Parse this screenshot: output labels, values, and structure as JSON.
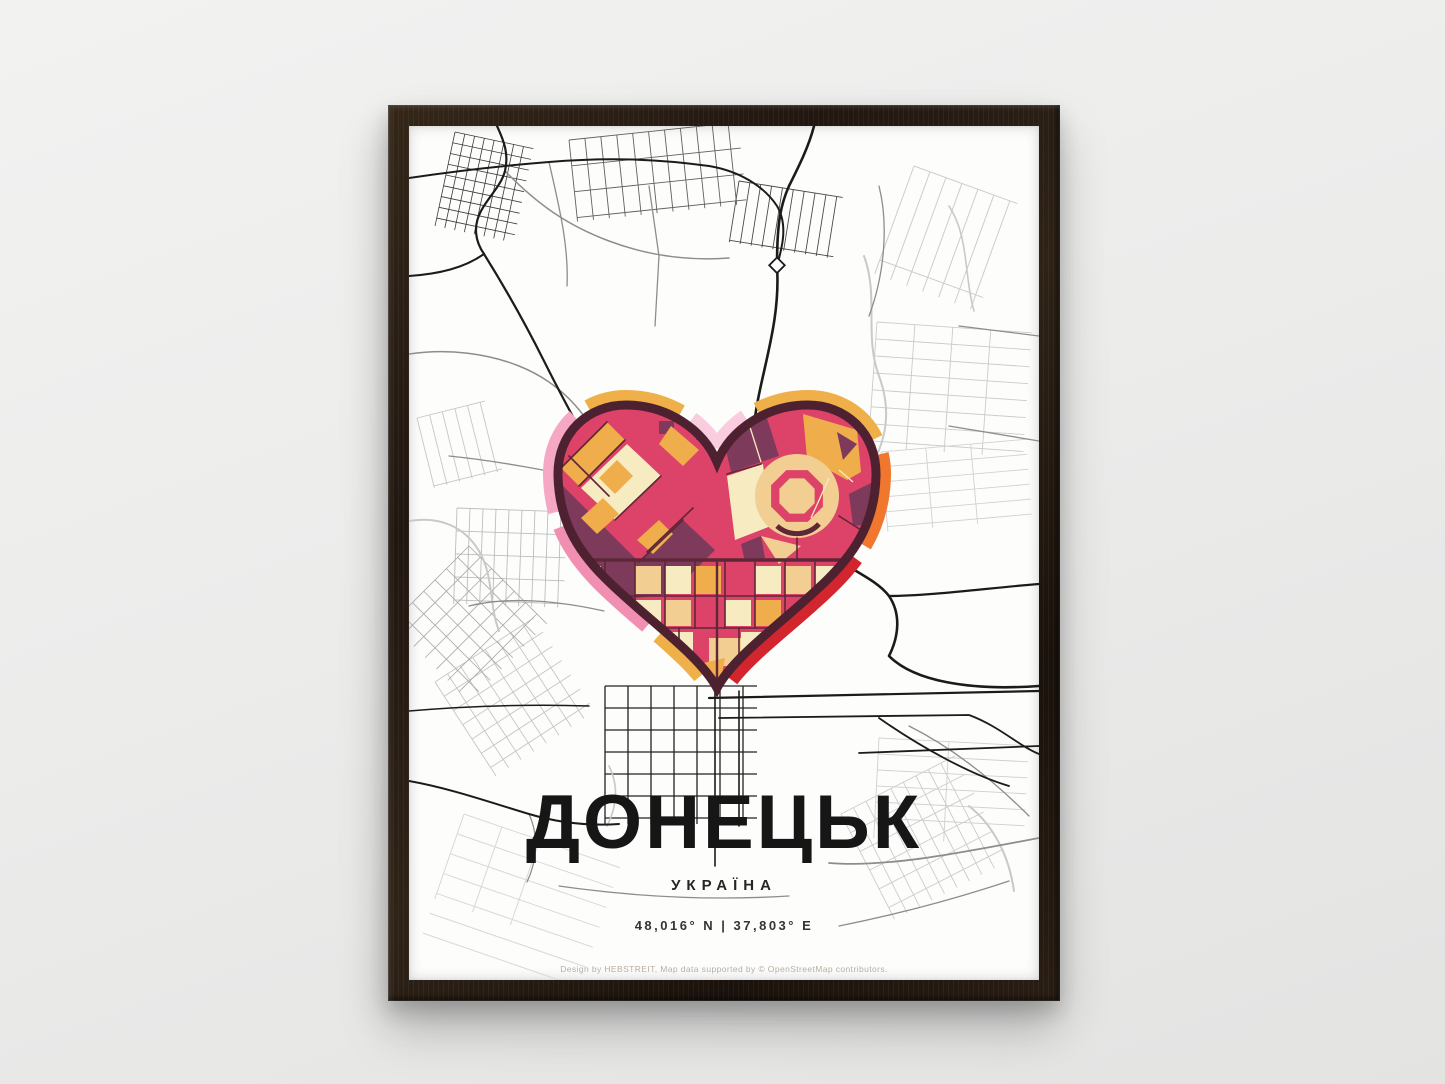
{
  "poster": {
    "title": "ДОНЕЦЬК",
    "subtitle": "УКРАЇНА",
    "coordinates": "48,016° N | 37,803° E",
    "credit": "Design by HEBSTREIT, Map data supported by © OpenStreetMap contributors.",
    "colors": {
      "wall": "#ebebea",
      "frame_wood": "#241810",
      "paper": "#fdfdfc",
      "road_black": "#1b1b1b",
      "road_gray": "#8d8d8d",
      "road_light": "#c9c9c9",
      "heart_outline": "#4e2130",
      "heart_crimson": "#dd4368",
      "heart_purple": "#7d3a5a",
      "heart_cream": "#f7ecc1",
      "heart_sand": "#f2ce93",
      "heart_amber": "#efae4b",
      "ring_pink": "#f18fb2",
      "ring_pink_light": "#f5a7c4",
      "ring_pale_pink": "#f9cddd",
      "ring_amber": "#efb04a",
      "ring_orange": "#f0772d",
      "ring_red": "#d2252e"
    }
  }
}
